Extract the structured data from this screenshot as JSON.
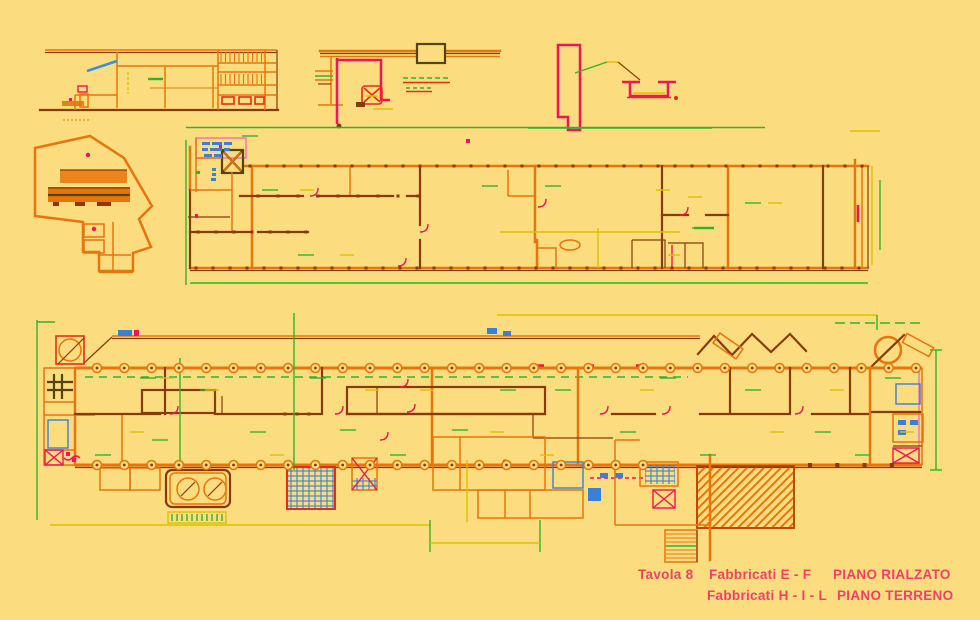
{
  "palette": {
    "bg": "#FBDC7E",
    "wall": "#E8740C",
    "wallDark": "#C24A04",
    "maroon": "#8A3A0A",
    "dark": "#554312",
    "green": "#2FB42F",
    "dimYellow": "#DCC100",
    "crimson": "#F0145A",
    "pink": "#F070B8",
    "blue": "#3C7FD6",
    "red": "#E03018",
    "captionPink": "#F23F6B"
  },
  "caption": {
    "line1": {
      "tavola": "Tavola 8",
      "fabbricati": "Fabbricati  E - F",
      "piano": "PIANO RIALZATO"
    },
    "line2": {
      "fabbricati": "Fabbricati H - I - L",
      "piano": "PIANO TERRENO"
    }
  }
}
